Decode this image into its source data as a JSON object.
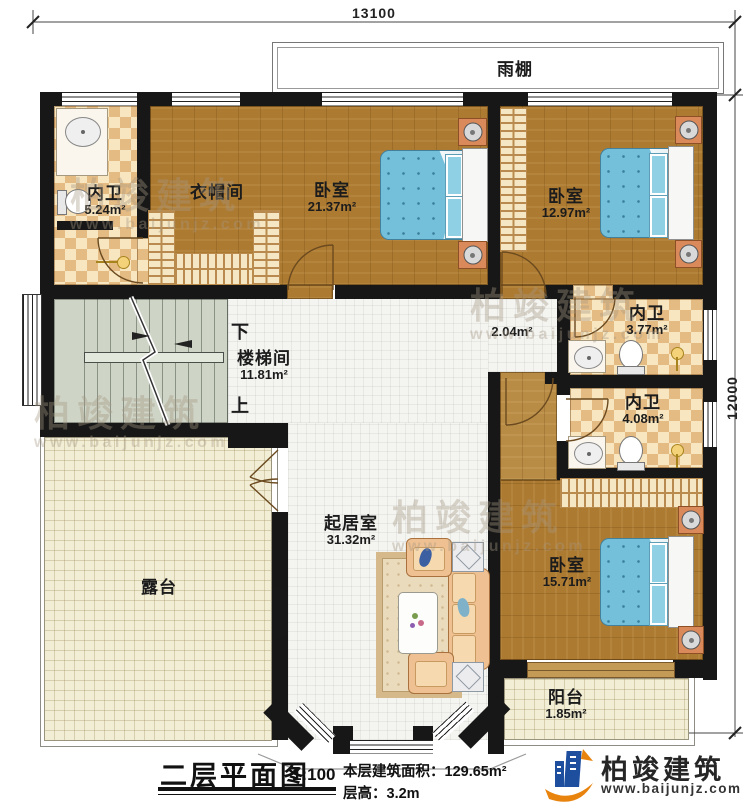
{
  "dimensions": {
    "top": "13100",
    "right": "12000"
  },
  "canopy": {
    "label": "雨棚"
  },
  "rooms": {
    "bath1": {
      "name": "内卫",
      "area": "5.24m²"
    },
    "cloak": {
      "name": "衣帽间"
    },
    "bed1": {
      "name": "卧室",
      "area": "21.37m²"
    },
    "bed2": {
      "name": "卧室",
      "area": "12.97m²"
    },
    "bath2": {
      "name": "内卫",
      "area": "3.77m²"
    },
    "bath3": {
      "name": "内卫",
      "area": "4.08m²"
    },
    "hall": {
      "area": "2.04m²"
    },
    "stairwell": {
      "name": "楼梯间",
      "area": "11.81m²",
      "down_label": "下",
      "up_label": "上"
    },
    "living": {
      "name": "起居室",
      "area": "31.32m²"
    },
    "terrace": {
      "name": "露台"
    },
    "bed3": {
      "name": "卧室",
      "area": "15.71m²"
    },
    "balcony": {
      "name": "阳台",
      "area": "1.85m²"
    }
  },
  "titleblock": {
    "title": "二层平面图",
    "scale": "1:100",
    "area_label": "本层建筑面积：",
    "area_value": "129.65m²",
    "height_label": "层高：",
    "height_value": "3.2m"
  },
  "brand": {
    "name": "柏竣建筑",
    "website": "www.baijunjz.com"
  },
  "watermark": {
    "name": "柏竣建筑",
    "website": "www.baijunjz.com"
  },
  "colors": {
    "wall": "#171717",
    "wood": "#ad7a31",
    "tile_light": "#f7e6c0",
    "tile_dark": "#e5bb84",
    "bed_blue": "#74c0da",
    "stair": "#ced4c6",
    "terrace_tile": "#f2edd5",
    "brand_blue": "#1e4f9e",
    "brand_orange": "#e8830d"
  }
}
